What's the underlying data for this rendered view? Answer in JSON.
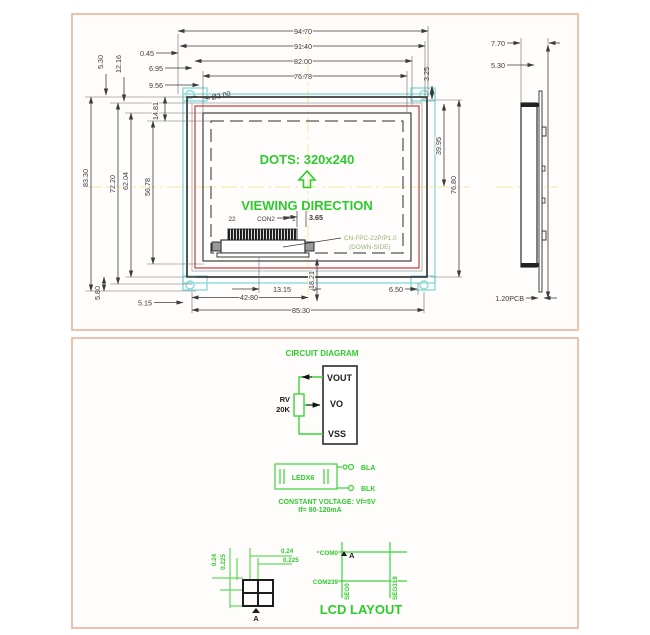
{
  "top_panel": {
    "front_view": {
      "dims_top": [
        "94.70",
        "91.40",
        "82.00",
        "76.78"
      ],
      "dims_left_h": [
        "0.45",
        "6.95",
        "9.56"
      ],
      "dims_left_v_small": [
        "5.30",
        "12.16",
        "14.81"
      ],
      "dims_left_v": [
        "83.30",
        "72.20",
        "62.04",
        "56.78"
      ],
      "dims_right_v": [
        "3.25",
        "39.95",
        "76.80"
      ],
      "dim_13": "13.15",
      "dim_18": "18.21",
      "dim_42": "42.80",
      "dim_85": "85.30",
      "dim_650": "6.50",
      "dim_515": "5.15",
      "dim_580": "5.80",
      "hole_label": "Ø3.00",
      "dots_label": "DOTS: 320x240",
      "viewing_label": "VIEWING DIRECTION",
      "connector": {
        "pin_left_label": "22",
        "name": "CON2",
        "pin_right_label": "1",
        "dim": "3.65",
        "type_line1": "CN-FPC-22P/P1.0",
        "type_line2": "(DOWN-SIDE)"
      }
    },
    "side_view": {
      "dim_total_thickness": "7.70",
      "dim_frame_thickness": "5.30",
      "dim_pcb": "1.20PCB"
    }
  },
  "bottom_panel": {
    "circuit": {
      "title": "CIRCUIT DIAGRAM",
      "pot_name": "RV",
      "pot_value": "20K",
      "pins": [
        "VOUT",
        "VO",
        "VSS"
      ]
    },
    "backlight": {
      "label": "LEDX6",
      "anode": "BLA",
      "cathode": "BLK",
      "note1": "CONSTANT VOLTAGE: Vf=5V",
      "note2": "If= 90-120mA"
    },
    "lcd_layout": {
      "title": "LCD LAYOUT",
      "dot_w": "0.24",
      "dot_pitch_w": "0.225",
      "dot_h": "0.24",
      "dot_pitch_h": "0.225",
      "com_first": "COM0",
      "com_last": "COM239",
      "seg_first": "SEG0",
      "seg_last": "SEG319",
      "marker_a": "A",
      "marker_a2": "A"
    }
  },
  "colors": {
    "green": "#2ecb2e",
    "cyan": "#8adcdc",
    "red": "#c64b4b",
    "yellow": "#ecec9c",
    "salmon": "#e9b29a"
  }
}
